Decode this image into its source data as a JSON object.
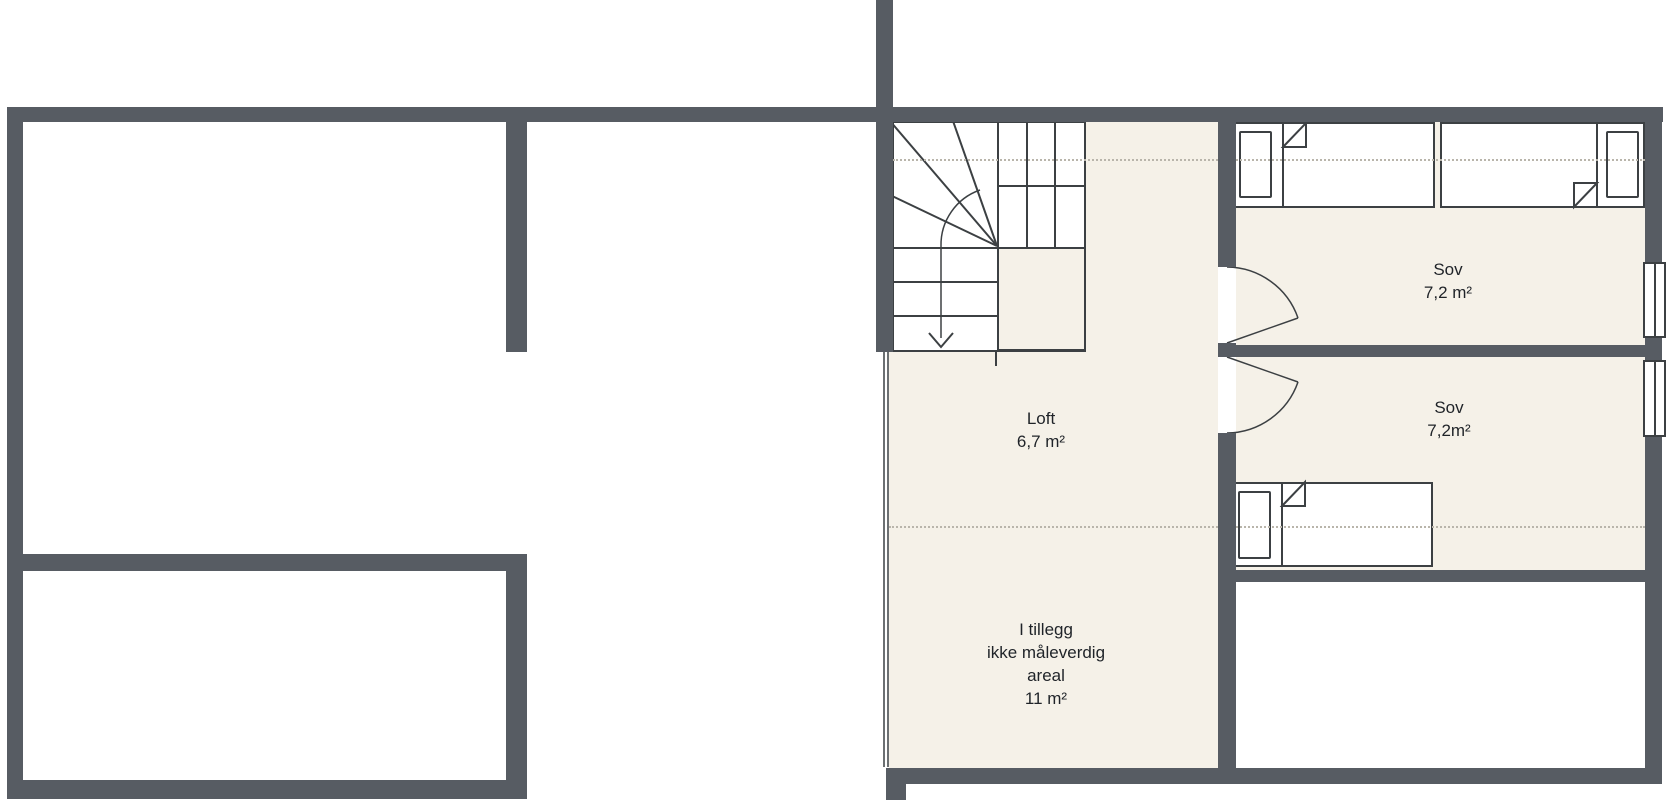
{
  "labels": {
    "loft": {
      "name": "Loft",
      "area": "6,7 m²"
    },
    "sov1": {
      "name": "Sov",
      "area": "7,2 m²"
    },
    "sov2": {
      "name": "Sov",
      "area": "7,2m²"
    },
    "extra": {
      "lines": [
        "I tillegg",
        "ikke måleverdig",
        "areal",
        "11 m²"
      ]
    }
  },
  "colors": {
    "wall": "#575c63",
    "floor": "#f5f1e8",
    "line": "#3c4043",
    "dotted": "#b9b5ab",
    "text": "#1f2328"
  }
}
